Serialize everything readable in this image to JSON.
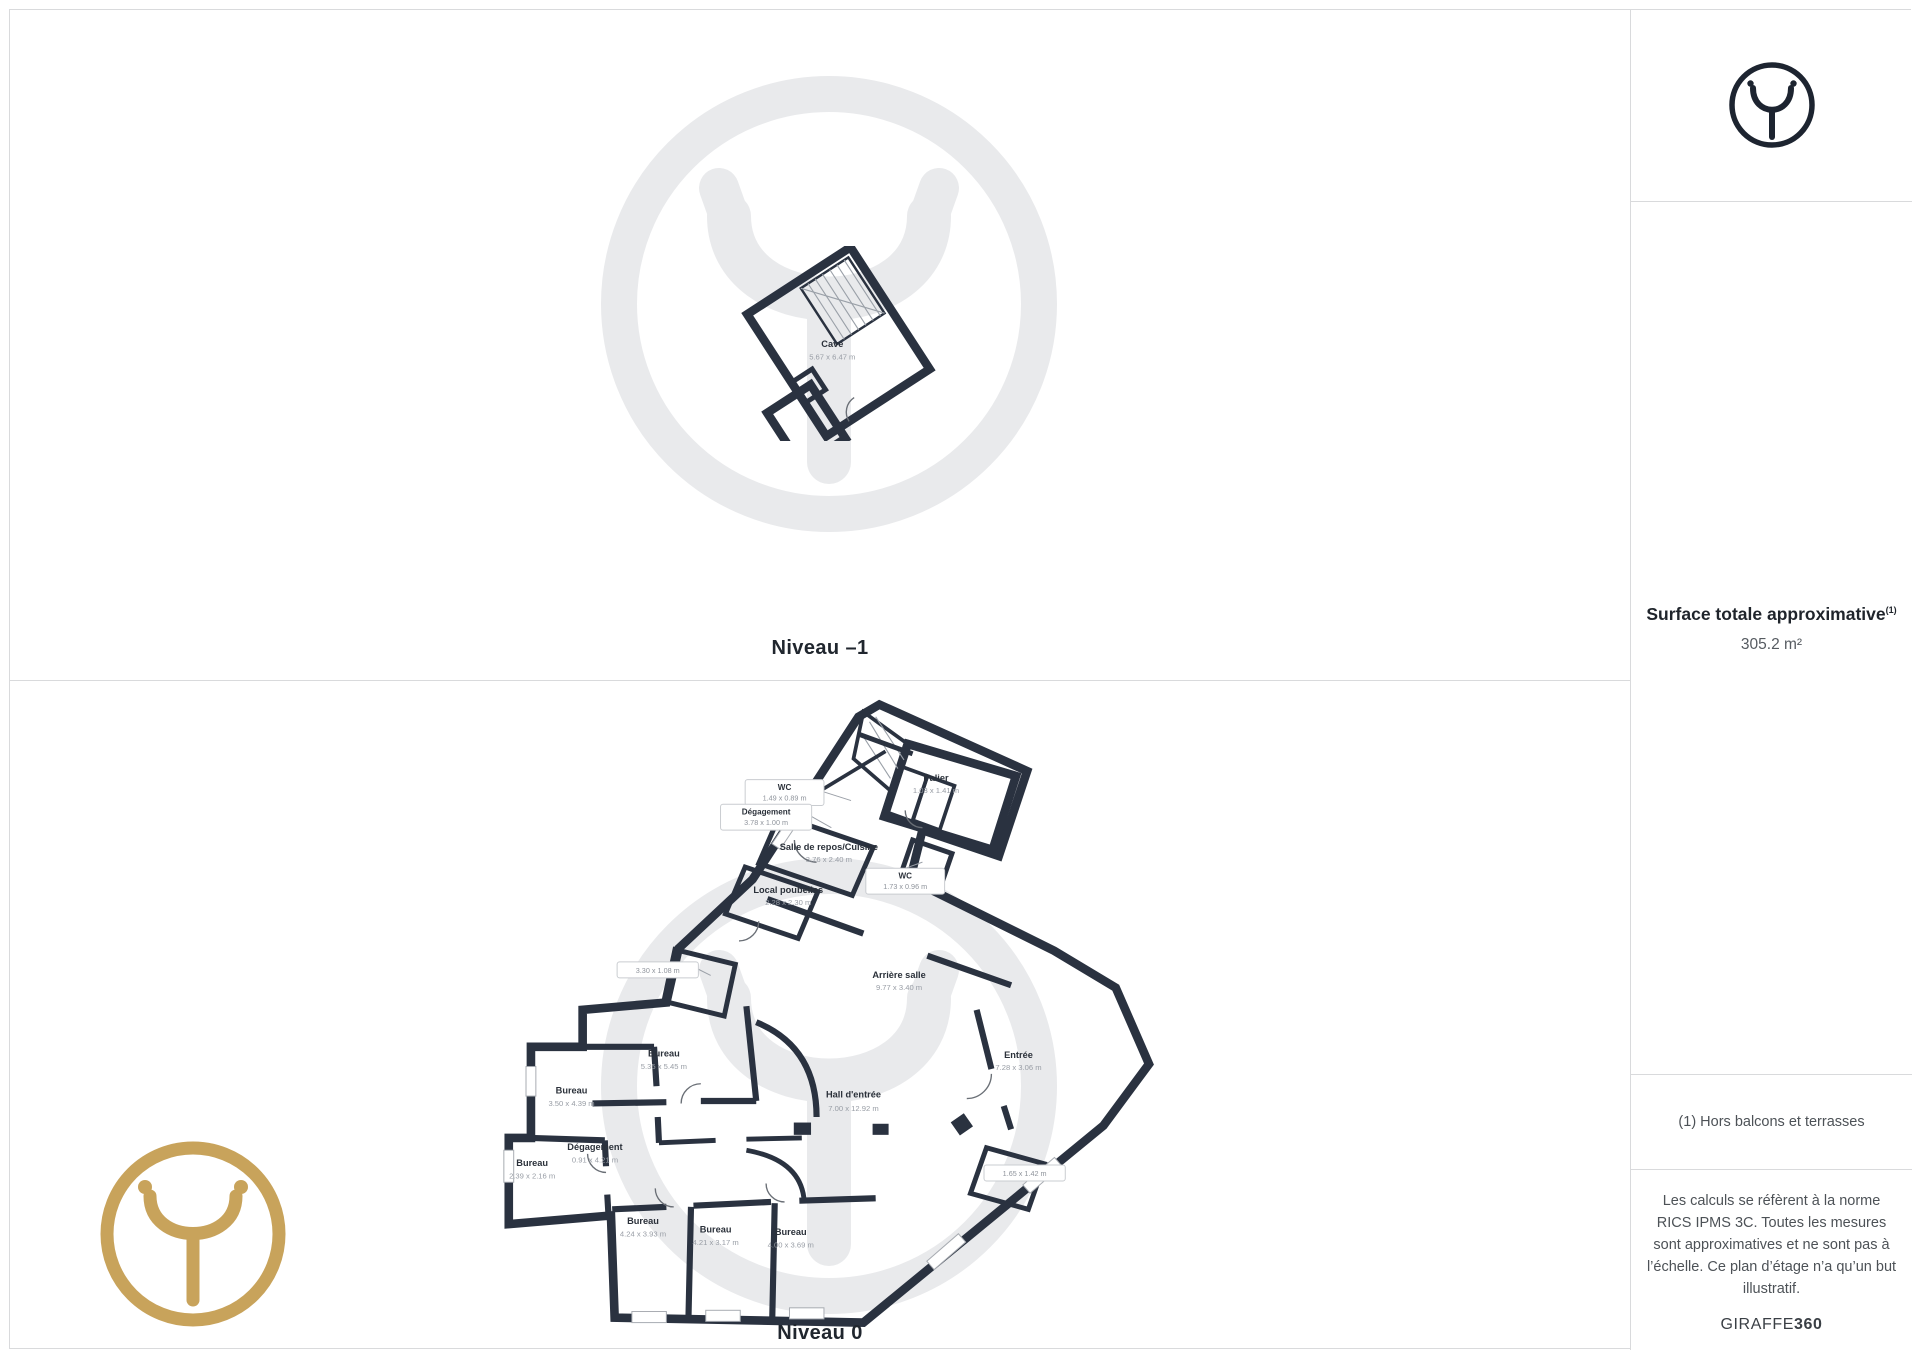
{
  "levels": [
    {
      "caption": "Niveau –1",
      "rooms": [
        {
          "name": "Cave",
          "dims": "5.67 x 6.47 m"
        }
      ]
    },
    {
      "caption": "Niveau 0",
      "rooms": [
        {
          "name": "WC",
          "dims": "1.49 x 0.89 m"
        },
        {
          "name": "Dégagement",
          "dims": "3.78 x 1.00 m"
        },
        {
          "name": "Salle de repos/Cuisine",
          "dims": "3.76 x 2.40 m"
        },
        {
          "name": "Palier",
          "dims": "1.03 x 1.41 m"
        },
        {
          "name": "WC",
          "dims": "1.73 x 0.96 m"
        },
        {
          "name": "Local poubelles",
          "dims": "2.28 x 2.30 m"
        },
        {
          "name": "",
          "dims": "3.30 x 1.08 m"
        },
        {
          "name": "Arrière salle",
          "dims": "9.77 x 3.40 m"
        },
        {
          "name": "Bureau",
          "dims": "5.35 x 5.45 m"
        },
        {
          "name": "Bureau",
          "dims": "3.50 x 4.39 m"
        },
        {
          "name": "Dégagement",
          "dims": "0.91 x 4.21 m"
        },
        {
          "name": "Bureau",
          "dims": "2.39 x 2.16 m"
        },
        {
          "name": "Hall d'entrée",
          "dims": "7.00 x 12.92 m"
        },
        {
          "name": "Entrée",
          "dims": "7.28 x 3.06 m"
        },
        {
          "name": "",
          "dims": "1.65 x 1.42 m"
        },
        {
          "name": "Bureau",
          "dims": "4.24 x 3.93 m"
        },
        {
          "name": "Bureau",
          "dims": "4.21 x 3.17 m"
        },
        {
          "name": "Bureau",
          "dims": "4.00 x 3.69 m"
        }
      ]
    }
  ],
  "sidebar": {
    "surface_title": "Surface totale approximative",
    "surface_sup": "(1)",
    "surface_value": "305.2 m²",
    "footnote": "(1) Hors balcons et terrasses",
    "disclaimer": "Les calculs se réfèrent à la norme RICS IPMS 3C. Toutes les mesures sont approximatives et ne sont pas à l’échelle. Ce plan d’étage n’a qu’un but illustratif.",
    "brand_regular": "GIRAFFE",
    "brand_bold": "360"
  },
  "colors": {
    "wall": "#2a3240",
    "room_beige": "#f2ddd3",
    "room_gray": "#dfe1e4",
    "room_light": "#eef0f4",
    "cave_floor": "#e3e5e8",
    "watermark_gray": "#e9eaec",
    "brand_gold": "#c8a35b",
    "logo_dark": "#1d2430"
  }
}
